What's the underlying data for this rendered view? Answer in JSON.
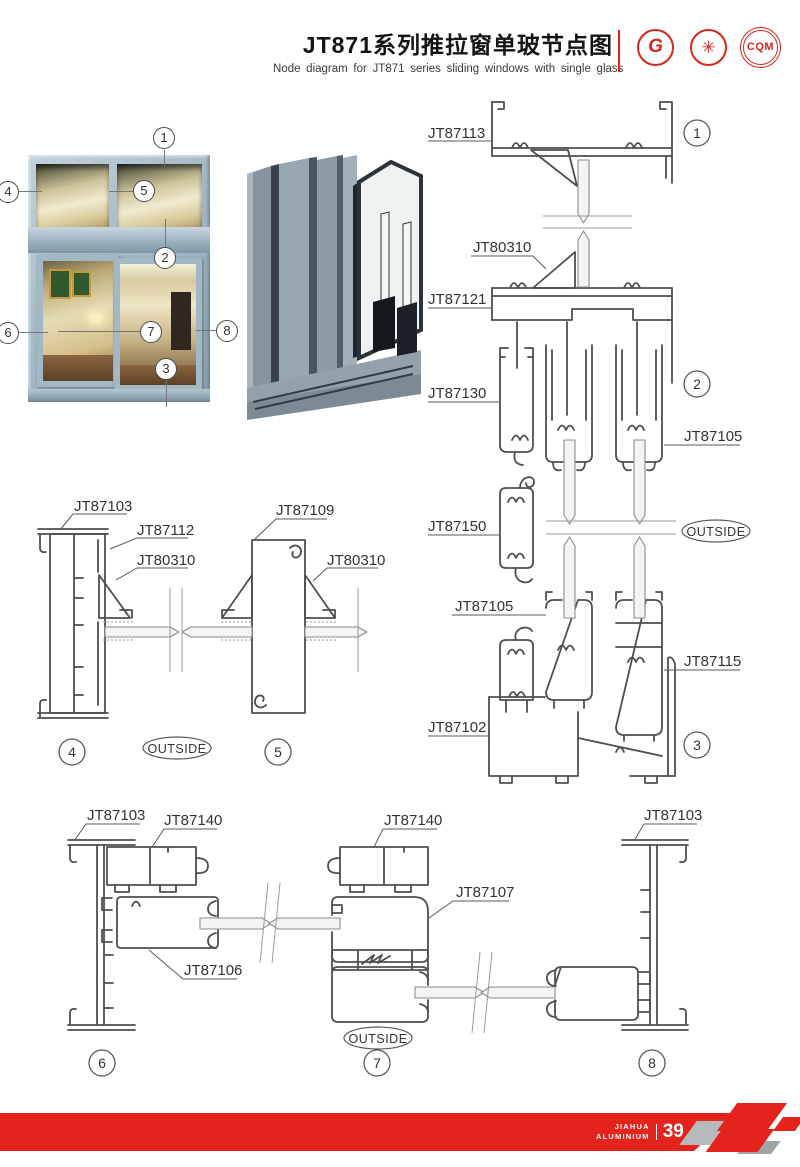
{
  "header": {
    "title_cn": "JT871系列推拉窗单玻节点图",
    "title_en": "Node diagram for JT871 series sliding windows with single glass",
    "logos": {
      "gb": "G",
      "seal": "✳",
      "cqm": "CQM"
    }
  },
  "photo": {
    "callouts": [
      "1",
      "4",
      "5",
      "2",
      "6",
      "7",
      "8",
      "3"
    ]
  },
  "diagram": {
    "outside_label": "OUTSIDE",
    "right_column": {
      "part_labels": [
        "JT87113",
        "JT80310",
        "JT87121",
        "JT87130",
        "JT87105",
        "JT87150",
        "JT87105",
        "JT87115",
        "JT87102"
      ],
      "node_badges": [
        "1",
        "2",
        "3"
      ]
    },
    "middle_row": {
      "part_labels": [
        "JT87103",
        "JT87112",
        "JT80310",
        "JT87109",
        "JT80310"
      ],
      "node_badges": [
        "4",
        "5"
      ]
    },
    "bottom_row": {
      "part_labels": [
        "JT87103",
        "JT87140",
        "JT87106",
        "JT87140",
        "JT87107",
        "JT87103"
      ],
      "node_badges": [
        "6",
        "7",
        "8"
      ]
    }
  },
  "footer": {
    "brand_line1": "JIAHUA",
    "brand_line2": "ALUMINIUM",
    "page_number": "39"
  },
  "colors": {
    "accent_red": "#e3231c",
    "line_gray": "#4f4f4f",
    "frame_blue": "#a9bfcc"
  }
}
